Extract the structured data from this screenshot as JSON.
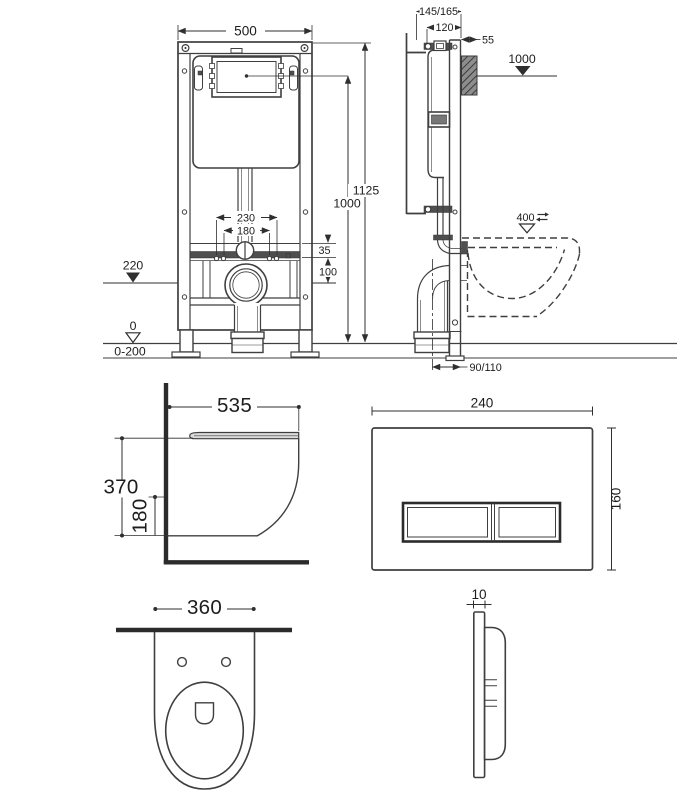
{
  "drawing": {
    "frame_front": {
      "width": "500",
      "total_height": "1125",
      "panel_height": "1000",
      "fixing_outer": "230",
      "fixing_inner": "180",
      "bracket_offset": "35",
      "outlet_drop": "100",
      "outlet_height": "220",
      "floor_level": "0",
      "floor_range": "0-200"
    },
    "frame_side": {
      "depth": "145/165",
      "frame_depth": "120",
      "plate_offset": "55",
      "panel_height": "1000",
      "rim_height": "400",
      "outlet_offset": "90/110"
    },
    "pan_side": {
      "depth": "535",
      "height": "370",
      "underside_height": "180"
    },
    "plate_front": {
      "width": "240",
      "height": "160"
    },
    "pan_top": {
      "width": "360"
    },
    "plate_side": {
      "thickness": "10"
    }
  },
  "colors": {
    "line": "#3f3f3f",
    "line_dark": "#2b2b2b",
    "dim": "#2f2f2f",
    "text": "#1d1d1d",
    "fill_dark": "#4f4f4f",
    "fill_light": "#dcdcdc",
    "hatch_bg": "#8d8d8d",
    "background": "#ffffff"
  }
}
